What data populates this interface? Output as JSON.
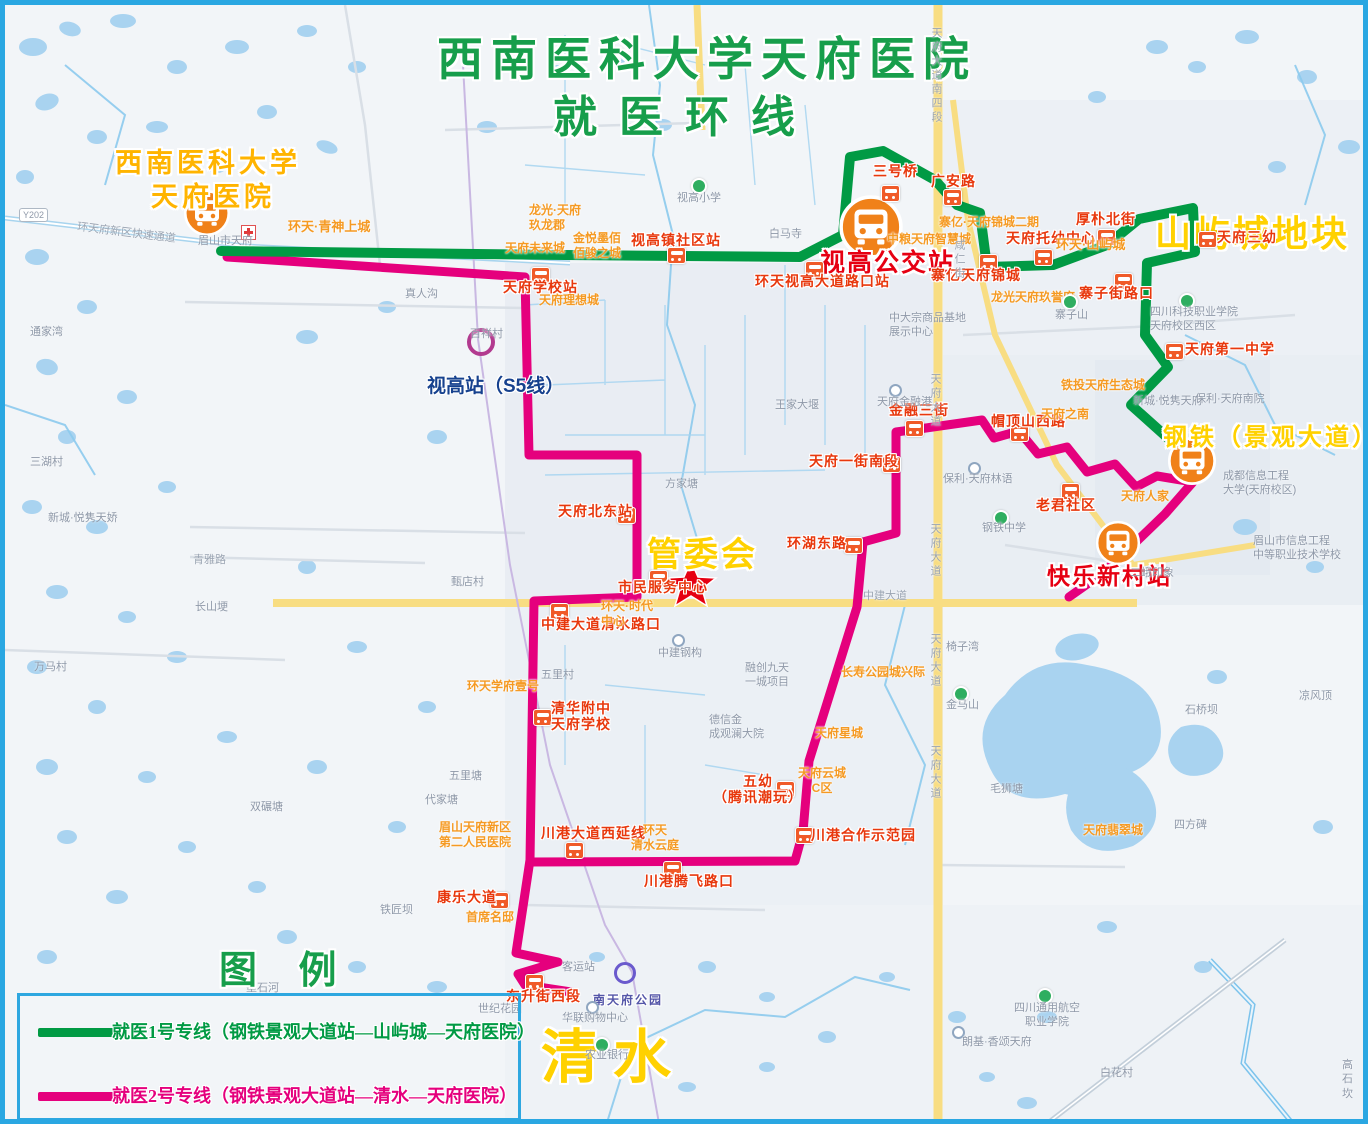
{
  "title": {
    "line1": "西南医科大学天府医院",
    "line2": "就医环线"
  },
  "legend": {
    "heading": "图 例",
    "items": [
      {
        "route": "1",
        "label": "就医1号专线（钢铁景观大道站—山屿城—天府医院）",
        "color": "#019a44"
      },
      {
        "route": "2",
        "label": "就医2号专线（钢铁景观大道站—清水—天府医院）",
        "color": "#e5007d"
      }
    ]
  },
  "callouts": {
    "hospital_line1": "西南医科大学",
    "hospital_line2": "天府医院",
    "shigao_bus_hub": "视高公交站",
    "shanyucheng": "山屿城地块",
    "gangtie": "钢铁（景观大道）",
    "kuaile": "快乐新村站",
    "guanweihui": "管委会",
    "qingshui": "清水"
  },
  "transit": {
    "s5_station": "视高站（S5线）",
    "park": "南天府公园",
    "road_badge": "Y202"
  },
  "stops": [
    {
      "label": "三号桥"
    },
    {
      "label": "广安路"
    },
    {
      "label": "厚朴北街"
    },
    {
      "label": "天府三幼"
    },
    {
      "label": "寨子街路口"
    },
    {
      "label": "天府第一中学"
    },
    {
      "label": "视高镇社区站"
    },
    {
      "label": "环天视高大道路口站"
    },
    {
      "label": "天府学校站"
    },
    {
      "label": "寨亿天府锦城"
    },
    {
      "label": "天府托幼中心"
    },
    {
      "label": "金融三街"
    },
    {
      "label": "帽顶山西路"
    },
    {
      "label": "天府一街南段"
    },
    {
      "label": "环湖东路"
    },
    {
      "label": "老君社区"
    },
    {
      "label": "天府北东站"
    },
    {
      "label": "市民服务中心"
    },
    {
      "label": "中建大道清水路口"
    },
    {
      "label": "清华附中\n天府学校"
    },
    {
      "label": "五幼\n（腾讯潮玩）"
    },
    {
      "label": "川港大道西延线"
    },
    {
      "label": "川港腾飞路口"
    },
    {
      "label": "川港合作示范园"
    },
    {
      "label": "康乐大道"
    },
    {
      "label": "东升街西段"
    }
  ],
  "areas": [
    {
      "label": "环天·青神上城"
    },
    {
      "label": "天府未来城"
    },
    {
      "label": "龙光·天府\n玖龙郡"
    },
    {
      "label": "金悦墨佰\n佰骏之城"
    },
    {
      "label": "天府理想城"
    },
    {
      "label": "中粮天府智慧城"
    },
    {
      "label": "寨亿·天府锦城二期"
    },
    {
      "label": "环天·山屿城"
    },
    {
      "label": "铁投天府生态城"
    },
    {
      "label": "天府之南"
    },
    {
      "label": "天府人家"
    },
    {
      "label": "环天·时代\n中心"
    },
    {
      "label": "环天学府壹号"
    },
    {
      "label": "眉山天府新区\n第二人民医院"
    },
    {
      "label": "环天\n清水云庭"
    },
    {
      "label": "天府云城\nC区"
    },
    {
      "label": "首席名邸"
    },
    {
      "label": "长寿公园城兴际"
    },
    {
      "label": "天府星城"
    },
    {
      "label": "天府翡翠城"
    },
    {
      "label": "龙光天府玖誉府"
    }
  ],
  "pois": [
    {
      "label": "视高小学"
    },
    {
      "label": "白马寺"
    },
    {
      "label": "王家大堰"
    },
    {
      "label": "天府金融港"
    },
    {
      "label": "保利·天府林语"
    },
    {
      "label": "钢铁中学"
    },
    {
      "label": "成都信息工程\n大学(天府校区)"
    },
    {
      "label": "眉山市信息工程\n中等职业技术学校"
    },
    {
      "label": "四川科技职业学院\n天府校区西区"
    },
    {
      "label": "寨子山"
    },
    {
      "label": "新城·悦隽天府"
    },
    {
      "label": "保利·天府南院"
    },
    {
      "label": "二峨印象"
    },
    {
      "label": "中建钢构"
    },
    {
      "label": "融创九天\n一城项目"
    },
    {
      "label": "五里村"
    },
    {
      "label": "五里塘"
    },
    {
      "label": "代家塘"
    },
    {
      "label": "德信金\n成观澜大院"
    },
    {
      "label": "椅子湾"
    },
    {
      "label": "金马山"
    },
    {
      "label": "毛狮塘"
    },
    {
      "label": "石桥坝"
    },
    {
      "label": "凉风顶"
    },
    {
      "label": "四方碑"
    },
    {
      "label": "华联购物中心"
    },
    {
      "label": "农业银行"
    },
    {
      "label": "客运站"
    },
    {
      "label": "世纪花园"
    },
    {
      "label": "白花村"
    },
    {
      "label": "高石坎"
    },
    {
      "label": "四川通用航空\n职业学院"
    },
    {
      "label": "朗基·香颂天府"
    },
    {
      "label": "真人沟"
    },
    {
      "label": "百祥村"
    },
    {
      "label": "甄店村"
    },
    {
      "label": "三湖村"
    },
    {
      "label": "通家湾"
    },
    {
      "label": "新城·悦隽天娇"
    },
    {
      "label": "长山埂"
    },
    {
      "label": "万马村"
    },
    {
      "label": "双碾塘"
    },
    {
      "label": "铁匠坝"
    },
    {
      "label": "墨石河"
    },
    {
      "label": "眉山市天府"
    },
    {
      "label": "中大宗商品基地\n展示中心"
    },
    {
      "label": "方家塘"
    }
  ],
  "roads": [
    {
      "label": "环天府新区快速通道"
    },
    {
      "label": "天府大道南四段"
    },
    {
      "label": "天府大道"
    },
    {
      "label": "天府大道"
    },
    {
      "label": "天府大道"
    },
    {
      "label": "天府大道"
    },
    {
      "label": "中建大道"
    },
    {
      "label": "咸仁街"
    },
    {
      "label": "青雅路"
    }
  ],
  "colors": {
    "route1_green": "#019a44",
    "route2_magenta": "#e5007d",
    "stop_red": "#e8380d",
    "callout_yellow": "#ffd100",
    "hospital_gold": "#ffb400",
    "title_green": "#179e4b",
    "water_blue": "#a9d3f0",
    "main_road_yellow": "#f8dd82",
    "bus_icon_orange": "#f08119"
  }
}
